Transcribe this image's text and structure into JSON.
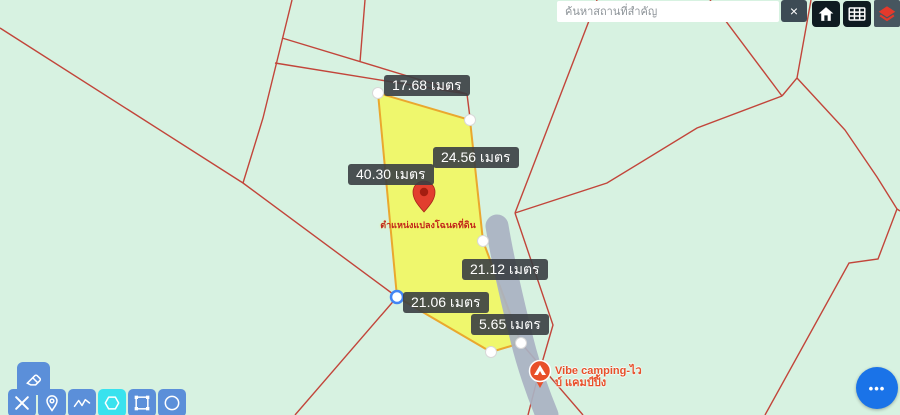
{
  "search": {
    "placeholder": "ค้นหาสถานที่สำคัญ",
    "clear_label": "×"
  },
  "topbar": {
    "buttons": [
      "home-icon",
      "grid-icon",
      "layers-icon"
    ]
  },
  "map": {
    "measurements": [
      {
        "text": "17.68 เมตร"
      },
      {
        "text": "24.56 เมตร"
      },
      {
        "text": "40.30 เมตร"
      },
      {
        "text": "21.12 เมตร"
      },
      {
        "text": "21.06 เมตร"
      },
      {
        "text": "5.65 เมตร"
      }
    ],
    "unit": "เมตร",
    "pin_caption": "ตำแหน่งแปลงโฉนดที่ดิน",
    "poi": {
      "line1": "Vibe camping-ไว",
      "line2": "บ์ แคมป์ปิ้ง"
    }
  },
  "toolbar": {
    "tools": [
      "eraser",
      "crossed-pencils",
      "place-marker",
      "measure-line",
      "draw-polygon",
      "draw-rectangle",
      "draw-circle"
    ],
    "active_tool": "draw-polygon"
  },
  "fab": {
    "label": "•••"
  },
  "colors": {
    "map_background": "#d7f2e1",
    "parcel_line": "#c2453a",
    "polygon_fill": "#f8f840",
    "polygon_stroke": "#eaa82e",
    "road": "#a9b2c2",
    "label_background": "#3a3e42",
    "pin_red": "#e23e2e",
    "poi_orange": "#e8502a",
    "tool_blue": "#5b8fd9",
    "tool_active_cyan": "#39e2ee",
    "fab_blue": "#1a73e8"
  }
}
